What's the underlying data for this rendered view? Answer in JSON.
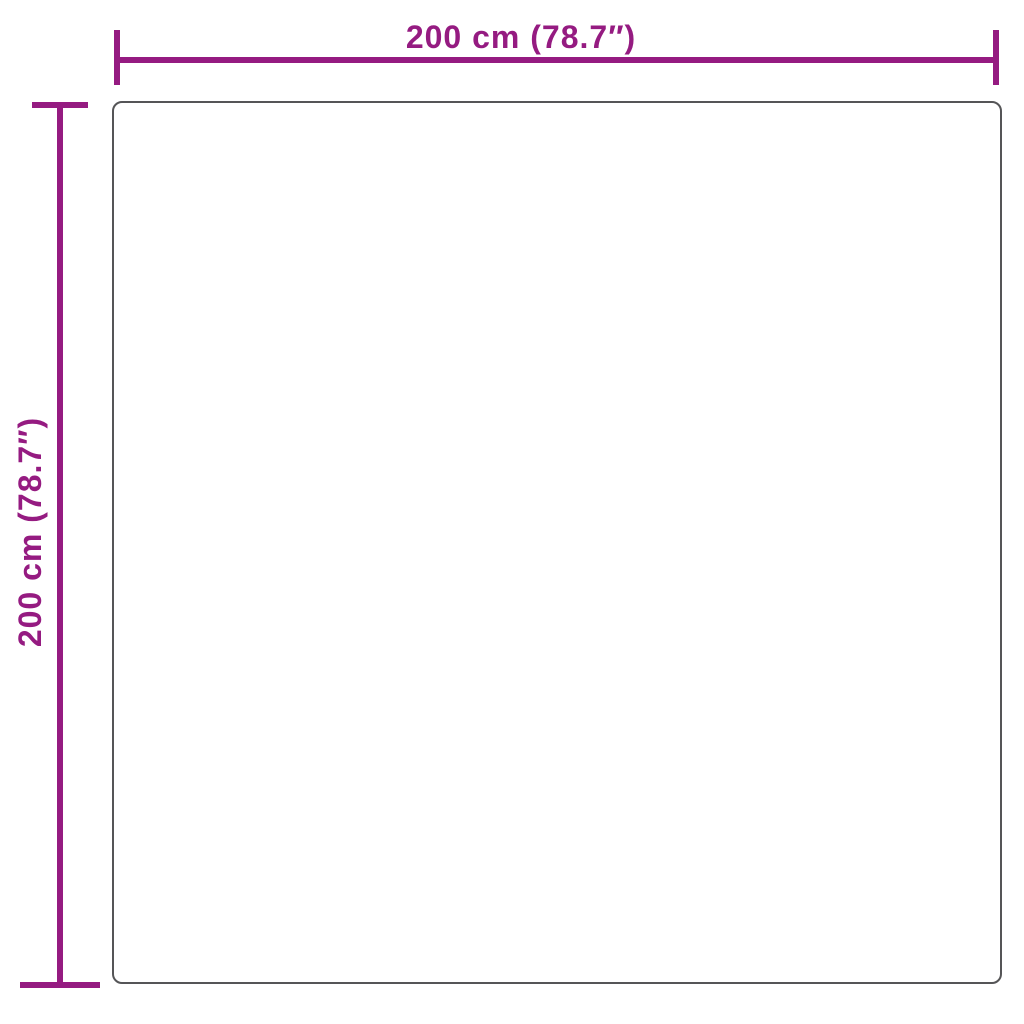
{
  "diagram": {
    "type": "product-dimension-diagram",
    "background_color": "#ffffff",
    "dimension_color": "#951b81",
    "outline_color": "#555557",
    "product_outline": {
      "shape": "rounded-square"
    },
    "width_dimension": {
      "label": "200 cm (78.7″)",
      "value_cm": "200",
      "value_in": "78.7"
    },
    "height_dimension": {
      "label": "200 cm (78.7″)",
      "value_cm": "200",
      "value_in": "78.7"
    }
  }
}
